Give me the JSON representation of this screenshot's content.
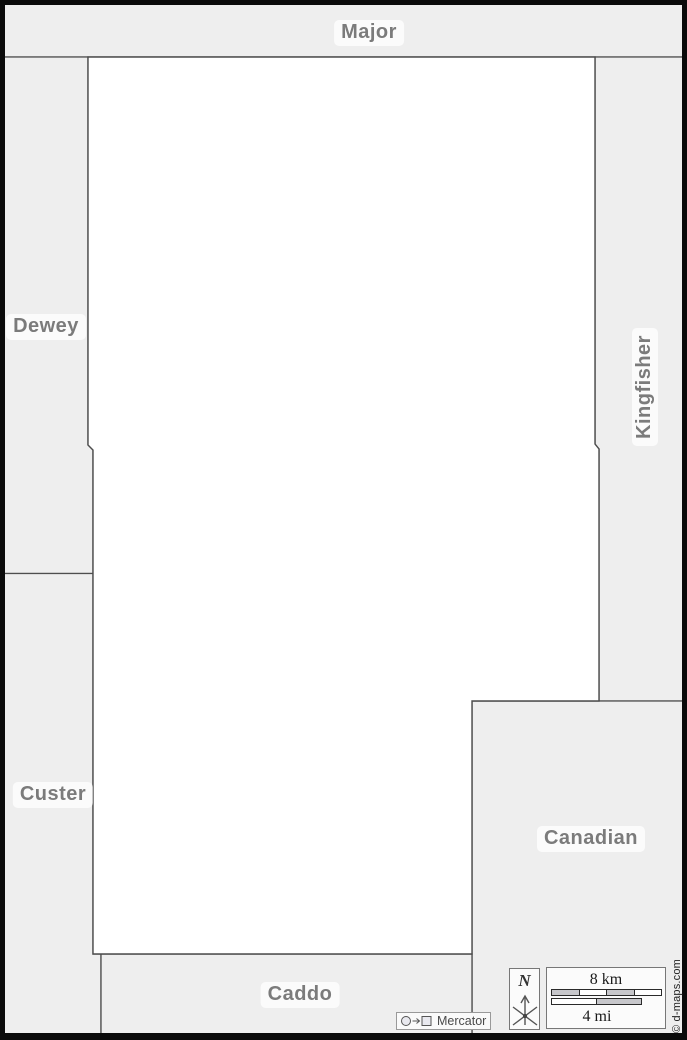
{
  "map_title": "County outline map",
  "labels": {
    "major": "Major",
    "dewey": "Dewey",
    "kingfisher": "Kingfisher",
    "custer": "Custer",
    "canadian": "Canadian",
    "caddo": "Caddo"
  },
  "compass": {
    "north_label": "N"
  },
  "scale": {
    "km_label": "8 km",
    "mi_label": "4 mi"
  },
  "projection": {
    "label": "Mercator"
  },
  "credit": "© d-maps.com",
  "colors": {
    "neighbor-fill": "#eeeeee",
    "county-fill": "#ffffff",
    "boundary": "#4d4d4d",
    "frame": "#0a0a0a",
    "label-text": "#7b7b7b",
    "scale-fill": "#c7c7cb"
  }
}
